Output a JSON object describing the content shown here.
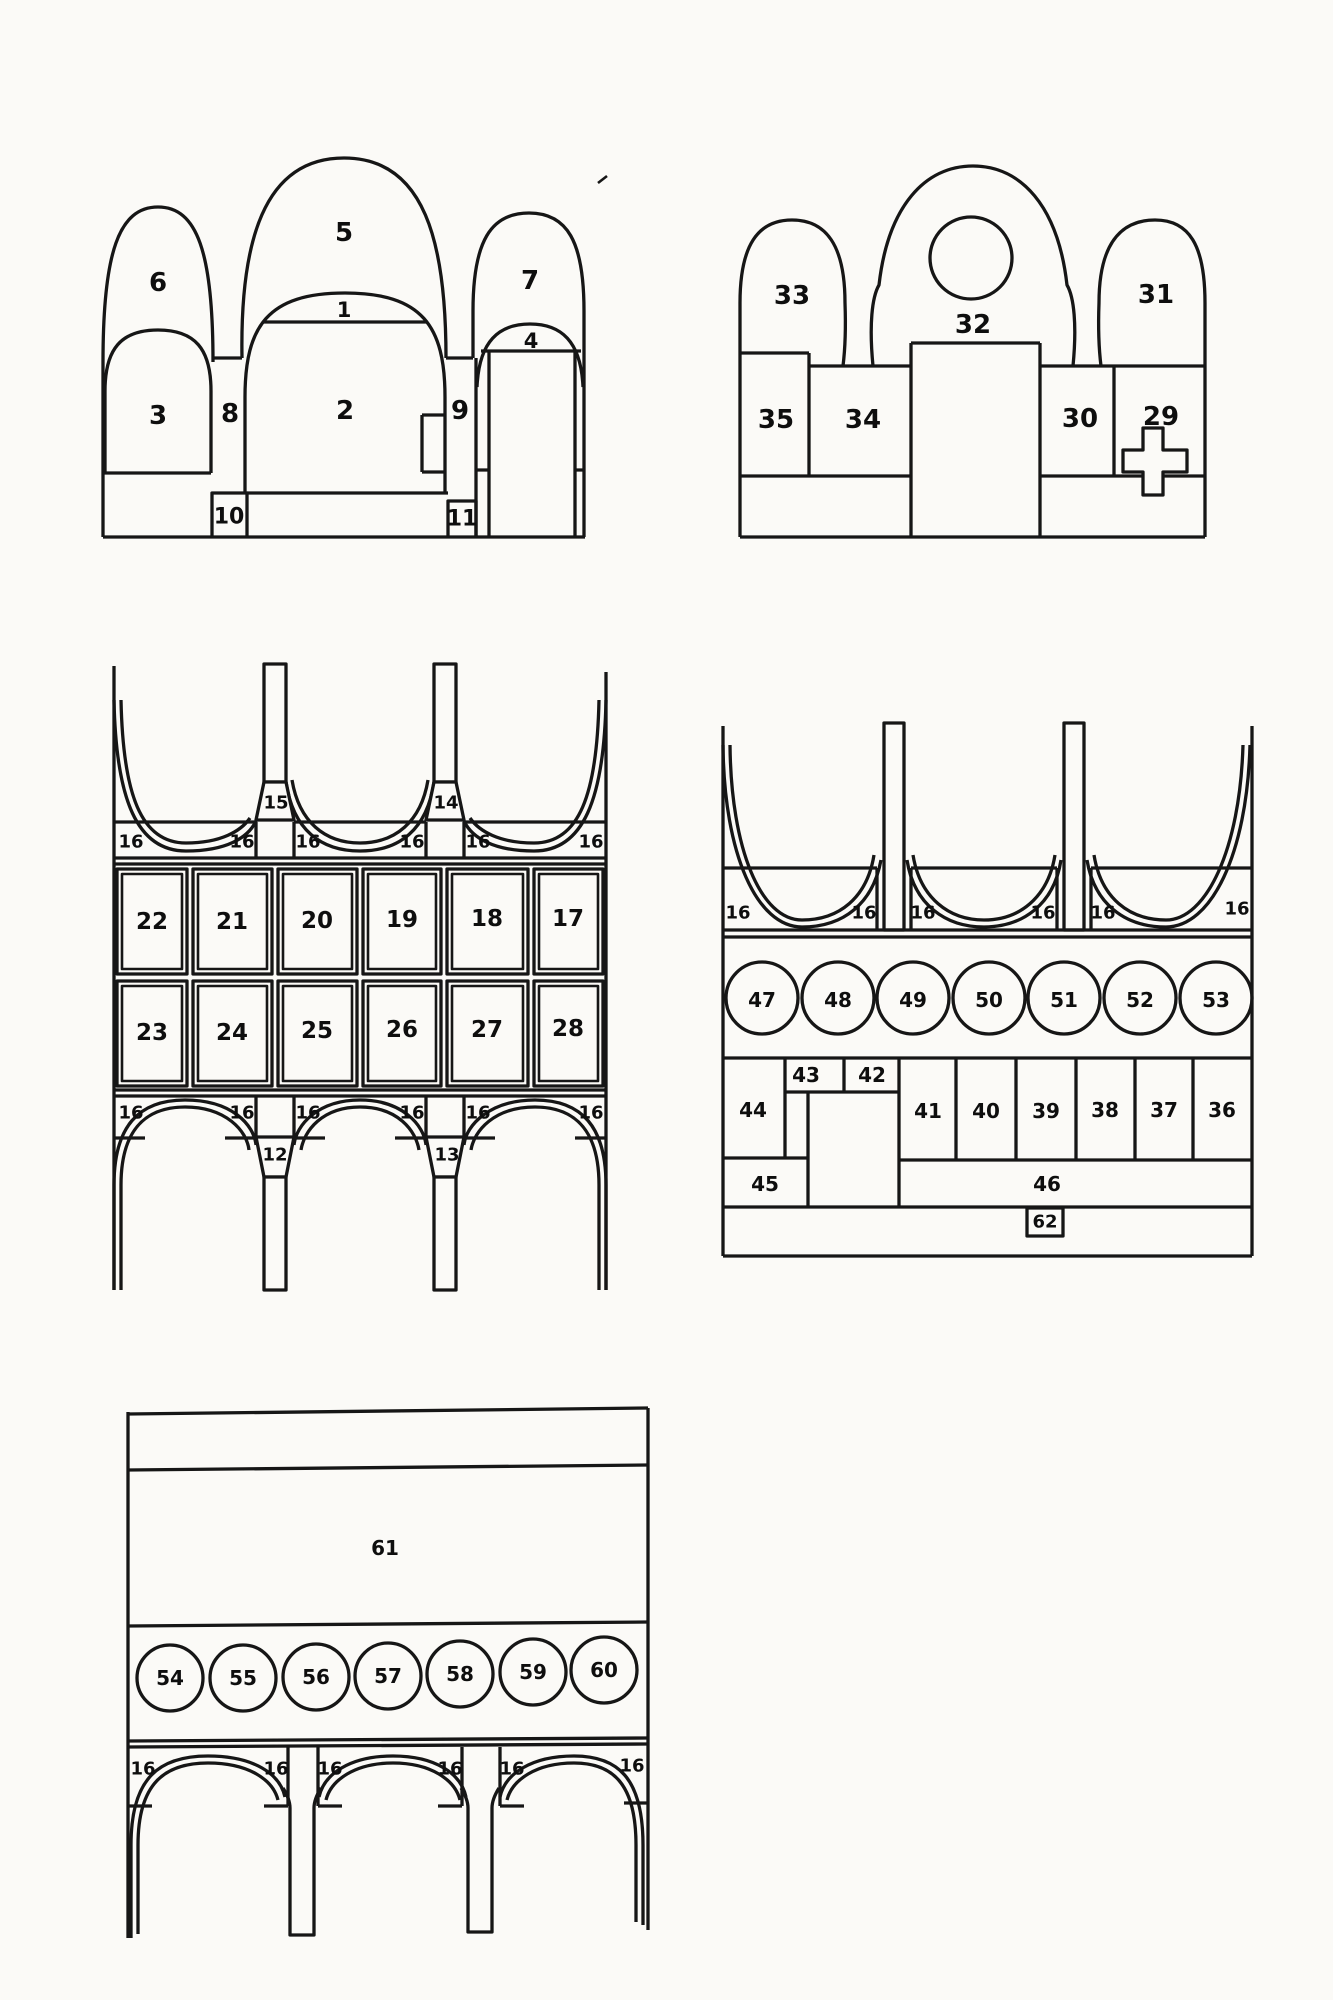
{
  "colors": {
    "paper": "#fbfaf7",
    "ink": "#161616",
    "label": "#0e0e0e"
  },
  "figure": {
    "kind": "numbered architectural elevation scheme",
    "panel_count": 5
  },
  "panels": [
    {
      "id": "facade-elevation-a",
      "labels": [
        {
          "text": "6",
          "x": 158,
          "y": 283,
          "size": 26
        },
        {
          "text": "5",
          "x": 344,
          "y": 233,
          "size": 26
        },
        {
          "text": "7",
          "x": 530,
          "y": 281,
          "size": 26
        },
        {
          "text": "1",
          "x": 344,
          "y": 310,
          "size": 21
        },
        {
          "text": "3",
          "x": 158,
          "y": 416,
          "size": 26
        },
        {
          "text": "8",
          "x": 230,
          "y": 414,
          "size": 26
        },
        {
          "text": "2",
          "x": 345,
          "y": 411,
          "size": 26
        },
        {
          "text": "9",
          "x": 460,
          "y": 411,
          "size": 26
        },
        {
          "text": "4",
          "x": 531,
          "y": 341,
          "size": 21
        },
        {
          "text": "10",
          "x": 229,
          "y": 517,
          "size": 22
        },
        {
          "text": "11",
          "x": 462,
          "y": 519,
          "size": 22
        }
      ]
    },
    {
      "id": "facade-elevation-b",
      "labels": [
        {
          "text": "33",
          "x": 792,
          "y": 296,
          "size": 26
        },
        {
          "text": "32",
          "x": 973,
          "y": 325,
          "size": 26
        },
        {
          "text": "31",
          "x": 1156,
          "y": 295,
          "size": 26
        },
        {
          "text": "35",
          "x": 776,
          "y": 420,
          "size": 26
        },
        {
          "text": "34",
          "x": 863,
          "y": 420,
          "size": 26
        },
        {
          "text": "30",
          "x": 1080,
          "y": 419,
          "size": 26
        },
        {
          "text": "29",
          "x": 1161,
          "y": 417,
          "size": 26
        }
      ]
    },
    {
      "id": "wall-scheme-a",
      "labels": [
        {
          "text": "15",
          "x": 276,
          "y": 803,
          "size": 18
        },
        {
          "text": "14",
          "x": 446,
          "y": 803,
          "size": 18
        },
        {
          "text": "16",
          "x": 131,
          "y": 842,
          "size": 18
        },
        {
          "text": "16",
          "x": 242,
          "y": 842,
          "size": 18
        },
        {
          "text": "16",
          "x": 308,
          "y": 842,
          "size": 18
        },
        {
          "text": "16",
          "x": 412,
          "y": 842,
          "size": 18
        },
        {
          "text": "16",
          "x": 478,
          "y": 842,
          "size": 18
        },
        {
          "text": "16",
          "x": 591,
          "y": 842,
          "size": 18
        },
        {
          "text": "22",
          "x": 152,
          "y": 922,
          "size": 23
        },
        {
          "text": "21",
          "x": 232,
          "y": 922,
          "size": 23
        },
        {
          "text": "20",
          "x": 317,
          "y": 921,
          "size": 23
        },
        {
          "text": "19",
          "x": 402,
          "y": 920,
          "size": 23
        },
        {
          "text": "18",
          "x": 487,
          "y": 919,
          "size": 23
        },
        {
          "text": "17",
          "x": 568,
          "y": 919,
          "size": 23
        },
        {
          "text": "23",
          "x": 152,
          "y": 1033,
          "size": 23
        },
        {
          "text": "24",
          "x": 232,
          "y": 1033,
          "size": 23
        },
        {
          "text": "25",
          "x": 317,
          "y": 1031,
          "size": 23
        },
        {
          "text": "26",
          "x": 402,
          "y": 1030,
          "size": 23
        },
        {
          "text": "27",
          "x": 487,
          "y": 1030,
          "size": 23
        },
        {
          "text": "28",
          "x": 568,
          "y": 1029,
          "size": 23
        },
        {
          "text": "16",
          "x": 131,
          "y": 1113,
          "size": 18
        },
        {
          "text": "16",
          "x": 242,
          "y": 1113,
          "size": 18
        },
        {
          "text": "16",
          "x": 308,
          "y": 1113,
          "size": 18
        },
        {
          "text": "16",
          "x": 412,
          "y": 1113,
          "size": 18
        },
        {
          "text": "16",
          "x": 478,
          "y": 1113,
          "size": 18
        },
        {
          "text": "16",
          "x": 591,
          "y": 1113,
          "size": 18
        },
        {
          "text": "12",
          "x": 275,
          "y": 1155,
          "size": 18
        },
        {
          "text": "13",
          "x": 447,
          "y": 1155,
          "size": 18
        }
      ]
    },
    {
      "id": "wall-scheme-b",
      "labels": [
        {
          "text": "16",
          "x": 738,
          "y": 913,
          "size": 18
        },
        {
          "text": "16",
          "x": 864,
          "y": 913,
          "size": 18
        },
        {
          "text": "16",
          "x": 923,
          "y": 913,
          "size": 18
        },
        {
          "text": "16",
          "x": 1043,
          "y": 913,
          "size": 18
        },
        {
          "text": "16",
          "x": 1103,
          "y": 913,
          "size": 18
        },
        {
          "text": "16",
          "x": 1237,
          "y": 909,
          "size": 18
        },
        {
          "text": "47",
          "x": 762,
          "y": 1000,
          "size": 20
        },
        {
          "text": "48",
          "x": 838,
          "y": 1000,
          "size": 20
        },
        {
          "text": "49",
          "x": 913,
          "y": 1000,
          "size": 20
        },
        {
          "text": "50",
          "x": 989,
          "y": 1000,
          "size": 20
        },
        {
          "text": "51",
          "x": 1064,
          "y": 1000,
          "size": 20
        },
        {
          "text": "52",
          "x": 1140,
          "y": 1000,
          "size": 20
        },
        {
          "text": "53",
          "x": 1216,
          "y": 1000,
          "size": 20
        },
        {
          "text": "43",
          "x": 806,
          "y": 1075,
          "size": 20
        },
        {
          "text": "42",
          "x": 872,
          "y": 1075,
          "size": 20
        },
        {
          "text": "44",
          "x": 753,
          "y": 1110,
          "size": 20
        },
        {
          "text": "41",
          "x": 928,
          "y": 1111,
          "size": 20
        },
        {
          "text": "40",
          "x": 986,
          "y": 1111,
          "size": 20
        },
        {
          "text": "39",
          "x": 1046,
          "y": 1111,
          "size": 20
        },
        {
          "text": "38",
          "x": 1105,
          "y": 1110,
          "size": 20
        },
        {
          "text": "37",
          "x": 1164,
          "y": 1110,
          "size": 20
        },
        {
          "text": "36",
          "x": 1222,
          "y": 1110,
          "size": 20
        },
        {
          "text": "45",
          "x": 765,
          "y": 1184,
          "size": 20
        },
        {
          "text": "46",
          "x": 1047,
          "y": 1184,
          "size": 20
        },
        {
          "text": "62",
          "x": 1045,
          "y": 1222,
          "size": 18
        }
      ]
    },
    {
      "id": "wall-scheme-c",
      "labels": [
        {
          "text": "61",
          "x": 385,
          "y": 1548,
          "size": 20
        },
        {
          "text": "54",
          "x": 170,
          "y": 1678,
          "size": 20
        },
        {
          "text": "55",
          "x": 243,
          "y": 1678,
          "size": 20
        },
        {
          "text": "56",
          "x": 316,
          "y": 1677,
          "size": 20
        },
        {
          "text": "57",
          "x": 388,
          "y": 1676,
          "size": 20
        },
        {
          "text": "58",
          "x": 460,
          "y": 1674,
          "size": 20
        },
        {
          "text": "59",
          "x": 533,
          "y": 1672,
          "size": 20
        },
        {
          "text": "60",
          "x": 604,
          "y": 1670,
          "size": 20
        },
        {
          "text": "16",
          "x": 143,
          "y": 1769,
          "size": 18
        },
        {
          "text": "16",
          "x": 276,
          "y": 1769,
          "size": 18
        },
        {
          "text": "16",
          "x": 330,
          "y": 1769,
          "size": 18
        },
        {
          "text": "16",
          "x": 450,
          "y": 1769,
          "size": 18
        },
        {
          "text": "16",
          "x": 512,
          "y": 1769,
          "size": 18
        },
        {
          "text": "16",
          "x": 632,
          "y": 1766,
          "size": 18
        }
      ]
    }
  ]
}
